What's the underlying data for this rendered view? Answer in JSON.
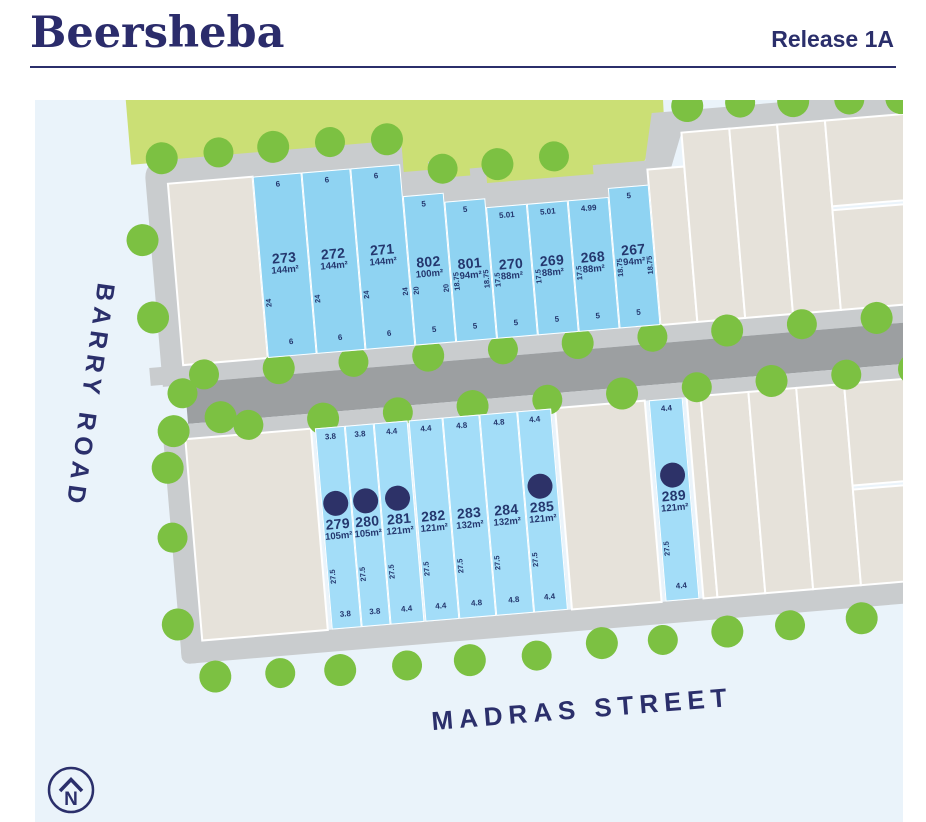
{
  "header": {
    "title": "Beersheba",
    "release": "Release 1A"
  },
  "streets": {
    "left": "BARRY ROAD",
    "bottom": "MADRAS STREET"
  },
  "compass": {
    "label": "N"
  },
  "colors": {
    "navy": "#2B2F6B",
    "lot_blue_north": "#8FD3F2",
    "lot_blue_south": "#A3DDF8",
    "sold_dot": "#2D3268",
    "tree_green": "#7CC142",
    "grass_green": "#CBDF75",
    "road_light": "#C9CCCE",
    "road_dark": "#9C9FA1",
    "parcel_beige": "#E6E2DA",
    "map_background": "#EAF3FA"
  },
  "plan": {
    "rows": [
      {
        "name": "north",
        "fill": "#8FD3F2",
        "lots": [
          {
            "id": "273",
            "area": "144m²",
            "front": "6",
            "rear": "6",
            "side_l": "24",
            "side_r": "",
            "sold": false,
            "x": 215,
            "w": 49.2,
            "top": 100,
            "h": 182
          },
          {
            "id": "272",
            "area": "144m²",
            "front": "6",
            "rear": "6",
            "side_l": "24",
            "side_r": "",
            "sold": false,
            "x": 264.2,
            "w": 49.2,
            "top": 100,
            "h": 182
          },
          {
            "id": "271",
            "area": "144m²",
            "front": "6",
            "rear": "6",
            "side_l": "24",
            "side_r": "24",
            "sold": false,
            "x": 313.4,
            "w": 49.2,
            "top": 100,
            "h": 182
          },
          {
            "id": "802",
            "area": "100m²",
            "front": "5",
            "rear": "5",
            "side_l": "20",
            "side_r": "20",
            "sold": false,
            "x": 362.6,
            "w": 41,
            "top": 132,
            "h": 150
          },
          {
            "id": "801",
            "area": "94m²",
            "front": "5",
            "rear": "5",
            "side_l": "18.75",
            "side_r": "18.75",
            "sold": false,
            "x": 403.6,
            "w": 41,
            "top": 141,
            "h": 141
          },
          {
            "id": "270",
            "area": "88m²",
            "front": "5.01",
            "rear": "5",
            "side_l": "17.5",
            "side_r": "",
            "sold": false,
            "x": 444.6,
            "w": 41.1,
            "top": 150,
            "h": 132
          },
          {
            "id": "269",
            "area": "88m²",
            "front": "5.01",
            "rear": "5",
            "side_l": "17.5",
            "side_r": "",
            "sold": false,
            "x": 485.7,
            "w": 41.1,
            "top": 150,
            "h": 132
          },
          {
            "id": "268",
            "area": "88m²",
            "front": "4.99",
            "rear": "5",
            "side_l": "17.5",
            "side_r": "",
            "sold": false,
            "x": 526.8,
            "w": 40.9,
            "top": 150,
            "h": 132
          },
          {
            "id": "267",
            "area": "94m²",
            "front": "5",
            "rear": "5",
            "side_l": "18.75",
            "side_r": "18.75",
            "sold": false,
            "x": 567.7,
            "w": 41,
            "top": 141,
            "h": 141
          }
        ]
      },
      {
        "name": "south",
        "fill": "#A3DDF8",
        "top": 356,
        "h": 202,
        "lots": [
          {
            "id": "279",
            "area": "105m²",
            "front": "3.8",
            "rear": "3.8",
            "side_l": "27.5",
            "side_r": "",
            "sold": true,
            "x": 256,
            "w": 29.6
          },
          {
            "id": "280",
            "area": "105m²",
            "front": "3.8",
            "rear": "3.8",
            "side_l": "27.5",
            "side_r": "",
            "sold": true,
            "x": 285.6,
            "w": 29.6
          },
          {
            "id": "281",
            "area": "121m²",
            "front": "4.4",
            "rear": "4.4",
            "side_l": "27.5",
            "side_r": "",
            "sold": true,
            "x": 315.2,
            "w": 34.3
          },
          {
            "id": "282",
            "area": "121m²",
            "front": "4.4",
            "rear": "4.4",
            "side_l": "27.5",
            "side_r": "",
            "sold": false,
            "x": 349.5,
            "w": 34.3
          },
          {
            "id": "283",
            "area": "132m²",
            "front": "4.8",
            "rear": "4.8",
            "side_l": "27.5",
            "side_r": "",
            "sold": false,
            "x": 383.8,
            "w": 37.4
          },
          {
            "id": "284",
            "area": "132m²",
            "front": "4.8",
            "rear": "4.8",
            "side_l": "27.5",
            "side_r": "",
            "sold": false,
            "x": 421.2,
            "w": 37.4
          },
          {
            "id": "285",
            "area": "121m²",
            "front": "4.4",
            "rear": "4.4",
            "side_l": "27.5",
            "side_r": "",
            "sold": true,
            "x": 458.6,
            "w": 34.3
          },
          {
            "id": "289",
            "area": "121m²",
            "front": "4.4",
            "rear": "4.4",
            "side_l": "27.5",
            "side_r": "",
            "sold": true,
            "x": 591,
            "w": 34
          }
        ]
      }
    ]
  }
}
